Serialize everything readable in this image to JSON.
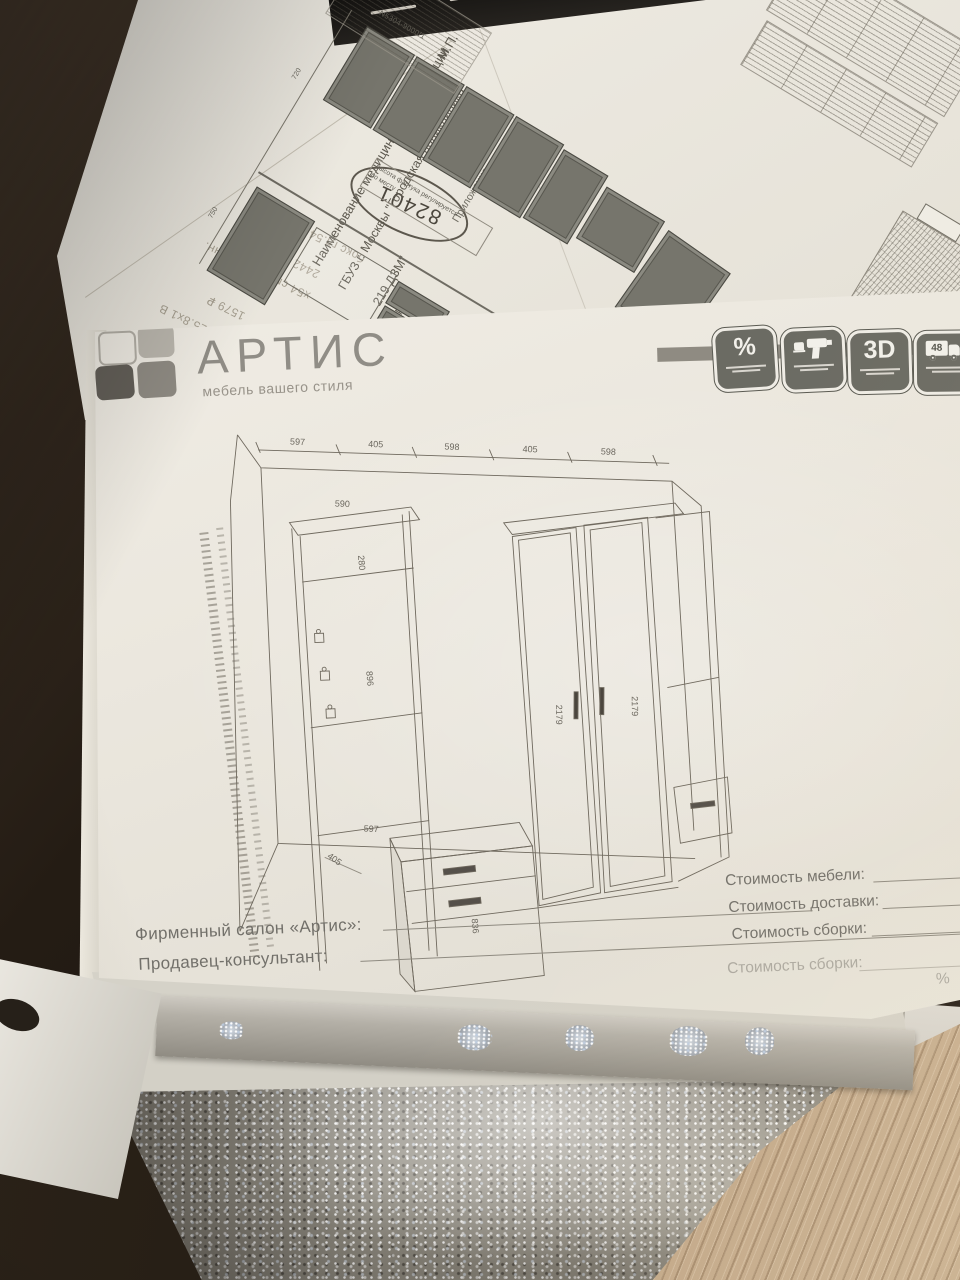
{
  "colors": {
    "sheet_white": "#f1eee6",
    "print_gray": "#6e6b63",
    "icon_tile_gray": "#6b6b63",
    "desk_wood_dark": "#32291f",
    "desk_wood_light": "#c4ac8c",
    "glitter_fabric": "#8e8a80",
    "handwriting_ink": "#30303c"
  },
  "artis_form": {
    "brand": {
      "name": "АРТИС",
      "tagline": "мебель вашего стиля"
    },
    "service_badges": [
      {
        "name": "discount",
        "glyph": "%"
      },
      {
        "name": "assembly-tools",
        "glyph": ""
      },
      {
        "name": "3d-design",
        "glyph": "3D"
      },
      {
        "name": "delivery-48h",
        "glyph": "48"
      }
    ],
    "drawing_dimensions": {
      "top_chain": [
        "597",
        "405",
        "598",
        "405",
        "598"
      ],
      "shelf_width": "590",
      "upper_section": "280",
      "mirror_height": "896",
      "inner_width": "597",
      "bracket": "405",
      "chest_height": "836",
      "left_door_height": "2179",
      "right_door_height": "2179"
    },
    "footer": {
      "salon_label": "Фирменный салон «Артис»:",
      "consultant_label": "Продавец-консультант:",
      "cost_furniture_label": "Стоимость мебели:",
      "cost_delivery_label": "Стоимость доставки:",
      "cost_assembly_label": "Стоимость сборки:",
      "percent": "%"
    },
    "bleedthrough": {
      "cost_assembly_label": "Стоимость сборки:",
      "percent": "%"
    }
  },
  "receipt_paper": {
    "circled_code": "82401",
    "faint_lines": [
      "бокс гл.54.5 дуб",
      "2442 ₽",
      "х54 см дуб молочн.",
      "1579 ₽",
      "99.6х225.8х1 В",
      "7257 ₽",
      "2х2322"
    ]
  },
  "medical_paper": {
    "org_label": "Наименование медицинской организации",
    "org_name_line1": "ГБУЗ г. Москвы \"Городская поликлиника",
    "org_name_line2": "219 ДЗМ\"",
    "address_label": "Адрес",
    "stamp_label": "М.П.",
    "attachment_label": "Приложение"
  },
  "kitchen_sheet": {
    "part_labels": [
      "N5304-9000/1",
      "N5340-03-9000",
      "N5342-01-9000",
      "N5343-04-9000/R",
      "N5304-9000/1"
    ],
    "dims": [
      "720",
      "750"
    ],
    "note_line1": "высота фартука регулируется",
    "note_line2": "по месту",
    "handwritten_mark": "60",
    "checkmark": "✓"
  }
}
